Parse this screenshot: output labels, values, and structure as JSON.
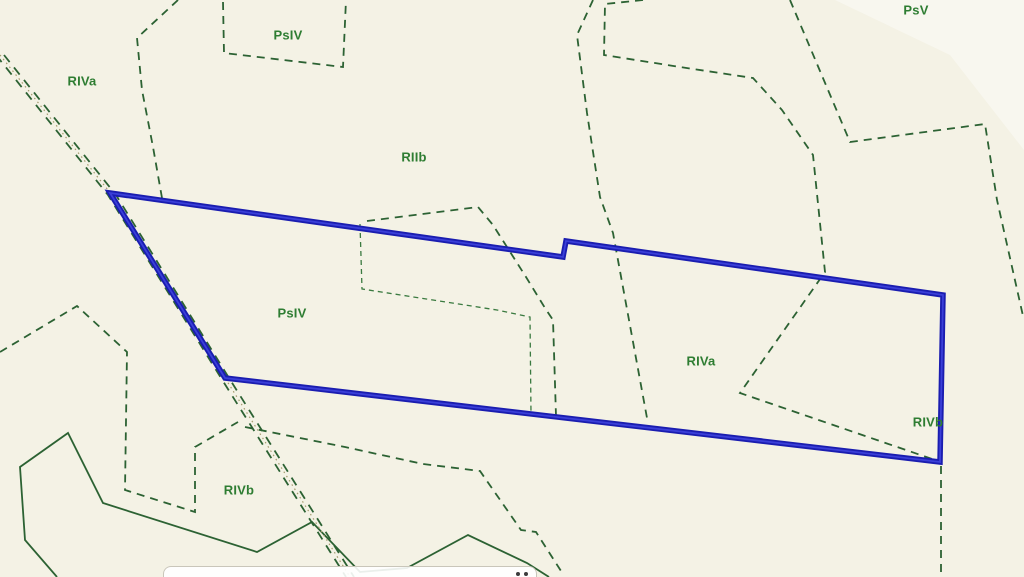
{
  "map": {
    "colors": {
      "background": "#f4f2e5",
      "line_green": "#2c6233",
      "line_green_fine": "#3a7a40",
      "label_green": "#2e7d32",
      "road_center": "#a49a6e",
      "parcel_blue": "#1a1db0",
      "parcel_blue_highlight": "#3a3fd8",
      "bar_background": "rgba(255,255,255,0.9)",
      "bar_border": "#c9c6ba",
      "bar_dot": "#3c3c3c",
      "sheen": "rgba(255,255,255,0.4)"
    },
    "labels": [
      {
        "text": "RIVa",
        "x": 82,
        "y": 82
      },
      {
        "text": "PsIV",
        "x": 288,
        "y": 36
      },
      {
        "text": "RIIb",
        "x": 414,
        "y": 158
      },
      {
        "text": "PsV",
        "x": 916,
        "y": 11
      },
      {
        "text": "PsIV",
        "x": 292,
        "y": 314
      },
      {
        "text": "RIVa",
        "x": 701,
        "y": 362
      },
      {
        "text": "RIVb",
        "x": 928,
        "y": 423
      },
      {
        "text": "RIVb",
        "x": 239,
        "y": 491
      }
    ],
    "green_features": [
      {
        "name": "psiv-box-boundary",
        "style": "dashed",
        "points": [
          [
            223,
            2
          ],
          [
            224,
            53
          ],
          [
            343,
            67
          ],
          [
            346,
            0
          ]
        ]
      },
      {
        "name": "riva-split-boundary",
        "style": "dashed",
        "points": [
          [
            178,
            0
          ],
          [
            137,
            38
          ],
          [
            142,
            90
          ],
          [
            153,
            147
          ],
          [
            162,
            198
          ]
        ]
      },
      {
        "name": "riib-east-boundary",
        "style": "dashed",
        "points": [
          [
            593,
            0
          ],
          [
            577,
            35
          ],
          [
            587,
            113
          ],
          [
            600,
            197
          ],
          [
            613,
            233
          ],
          [
            647,
            418
          ]
        ]
      },
      {
        "name": "northeast-boundary",
        "style": "dashed",
        "points": [
          [
            643,
            0
          ],
          [
            605,
            4
          ],
          [
            604,
            55
          ],
          [
            680,
            67
          ],
          [
            753,
            78
          ],
          [
            782,
            110
          ],
          [
            813,
            155
          ],
          [
            825,
            272
          ],
          [
            740,
            393
          ],
          [
            938,
            461
          ]
        ]
      },
      {
        "name": "far-east-boundary",
        "style": "dashed",
        "points": [
          [
            790,
            0
          ],
          [
            850,
            142
          ],
          [
            985,
            124
          ],
          [
            997,
            200
          ],
          [
            1023,
            316
          ]
        ]
      },
      {
        "name": "vertex-south-boundary",
        "style": "dashed",
        "points": [
          [
            941,
            466
          ],
          [
            941,
            577
          ]
        ]
      },
      {
        "name": "inner-peak-boundary",
        "style": "dashed",
        "points": [
          [
            367,
            221
          ],
          [
            478,
            207
          ],
          [
            493,
            225
          ],
          [
            526,
            277
          ],
          [
            545,
            308
          ],
          [
            553,
            320
          ],
          [
            556,
            416
          ]
        ]
      },
      {
        "name": "inner-parcel-boundary",
        "style": "fine",
        "points": [
          [
            360,
            224
          ],
          [
            362,
            289
          ],
          [
            433,
            300
          ],
          [
            497,
            310
          ],
          [
            530,
            317
          ],
          [
            531,
            414
          ]
        ]
      },
      {
        "name": "west-zigzag-boundary",
        "style": "dashed",
        "points": [
          [
            0,
            352
          ],
          [
            77,
            306
          ],
          [
            127,
            352
          ],
          [
            125,
            490
          ],
          [
            195,
            512
          ],
          [
            195,
            447
          ],
          [
            238,
            422
          ]
        ]
      },
      {
        "name": "road-branch-boundary",
        "style": "dashed",
        "points": [
          [
            245,
            427
          ],
          [
            345,
            447
          ],
          [
            423,
            464
          ],
          [
            480,
            471
          ],
          [
            521,
            530
          ],
          [
            536,
            532
          ],
          [
            561,
            571
          ]
        ]
      },
      {
        "name": "southwest-parcel-boundary",
        "style": "solid",
        "points": [
          [
            57,
            577
          ],
          [
            25,
            540
          ],
          [
            20,
            467
          ],
          [
            68,
            433
          ],
          [
            103,
            503
          ],
          [
            257,
            552
          ],
          [
            312,
            522
          ],
          [
            360,
            572
          ],
          [
            407,
            568
          ],
          [
            468,
            535
          ],
          [
            527,
            563
          ],
          [
            549,
            577
          ]
        ]
      }
    ],
    "road": {
      "points": [
        [
          0,
          55
        ],
        [
          112,
          195
        ],
        [
          225,
          378
        ],
        [
          350,
          577
        ]
      ],
      "edge_offset": 4
    },
    "parcel": {
      "points": [
        [
          110,
          193
        ],
        [
          563,
          257
        ],
        [
          566,
          241
        ],
        [
          943,
          295
        ],
        [
          940,
          462
        ],
        [
          225,
          378
        ]
      ],
      "closed": true
    },
    "sheen_wedge": [
      [
        835,
        0
      ],
      [
        1024,
        0
      ],
      [
        1024,
        150
      ],
      [
        950,
        55
      ]
    ],
    "toolbar": {
      "x": 163,
      "y": 566,
      "width": 374,
      "height": 16,
      "radius": 8,
      "dots": [
        [
          516,
          572
        ],
        [
          524,
          572
        ]
      ]
    }
  }
}
